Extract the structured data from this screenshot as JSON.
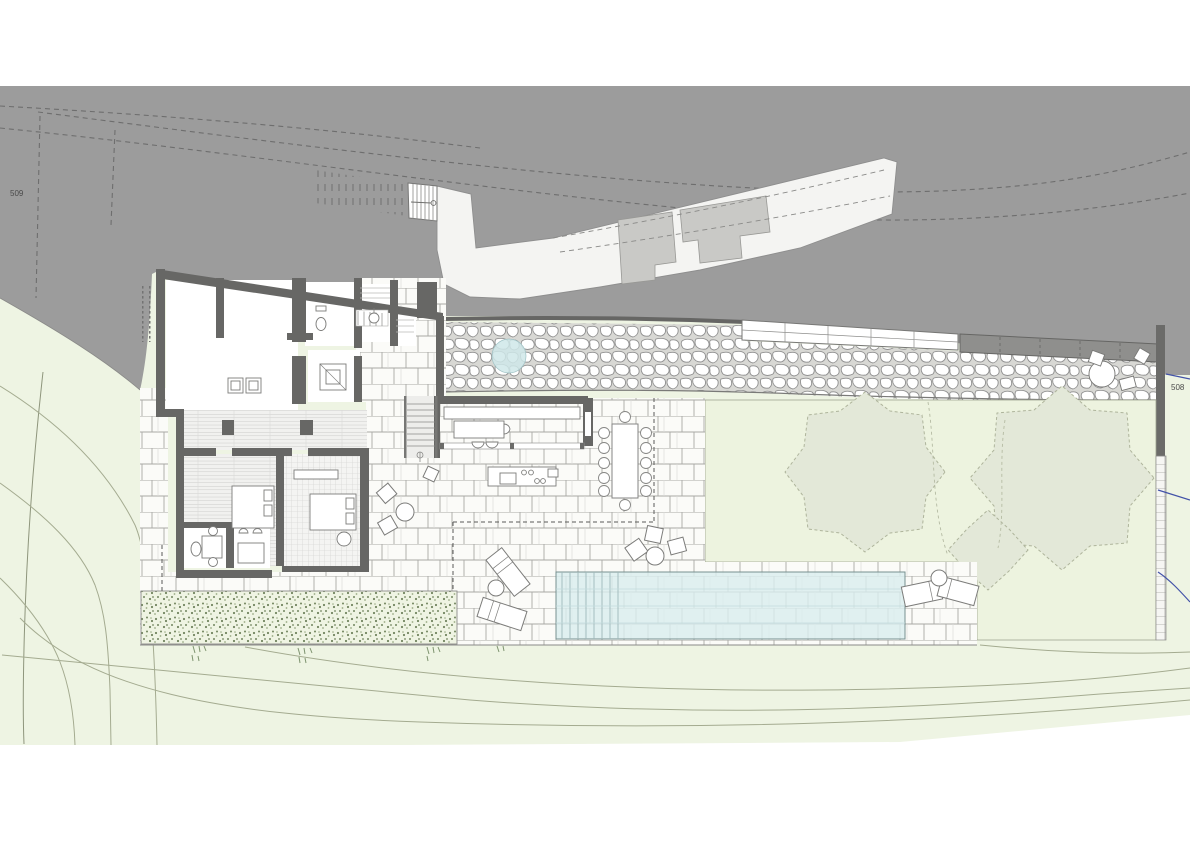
{
  "document": {
    "type": "architectural-site-plan",
    "view": "ground-floor-plan"
  },
  "labels": {
    "contour_left": "509",
    "contour_right": "508"
  },
  "colors": {
    "hillside_gray": "#9c9c9c",
    "wall_dark": "#676765",
    "paper_white": "#ffffff",
    "terrain_green": "#eef4e3",
    "lawn_green": "#edf3df",
    "tree_canopy": "#e3e8d8",
    "pool_water": "#d9edee",
    "pond_water": "#cfe7e9",
    "stone_grout": "#d8d8d4",
    "driveway": "#f4f4f2",
    "concrete_patch": "#c9c9c6",
    "boundary_blue": "#4252a8",
    "contour_line": "#a4ab90"
  }
}
